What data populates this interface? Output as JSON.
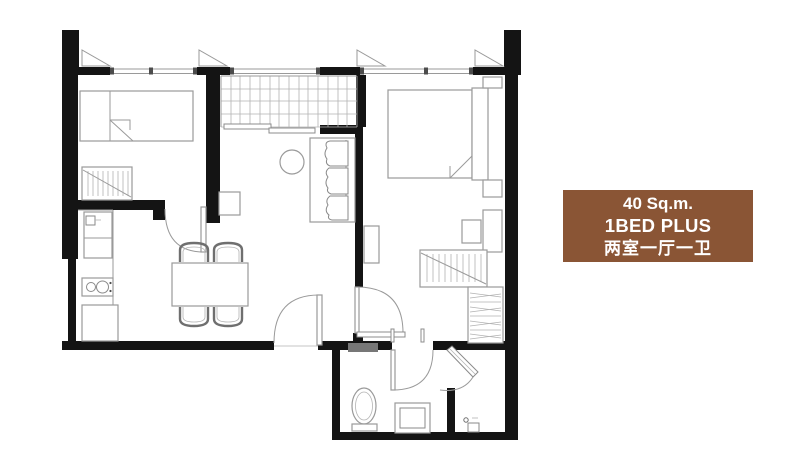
{
  "page": {
    "background": "#ffffff"
  },
  "info_card": {
    "area": "40 Sq.m.",
    "unit_type": "1BED PLUS",
    "layout_cn": "两室一厅一卫",
    "bg_color": "#8a5535",
    "text_color": "#ffffff"
  },
  "plan": {
    "wall_color": "#141414",
    "line_color": "#9a9a9a",
    "symbols": [
      "single-bed-icon",
      "double-bed-icon",
      "wardrobe-icon",
      "shelf-closet-icon",
      "sofa-icon",
      "round-table-icon",
      "dining-table-icon",
      "chair-icon",
      "kitchen-sink-icon",
      "stove-icon",
      "kitchen-cabinet-icon",
      "toilet-icon",
      "bathroom-sink-icon",
      "floor-drain-icon",
      "door-swing-icon",
      "entrance-shower-door-icon",
      "window-icon",
      "balcony-grid-icon",
      "sliding-door-icon",
      "nightstand-icon"
    ]
  }
}
